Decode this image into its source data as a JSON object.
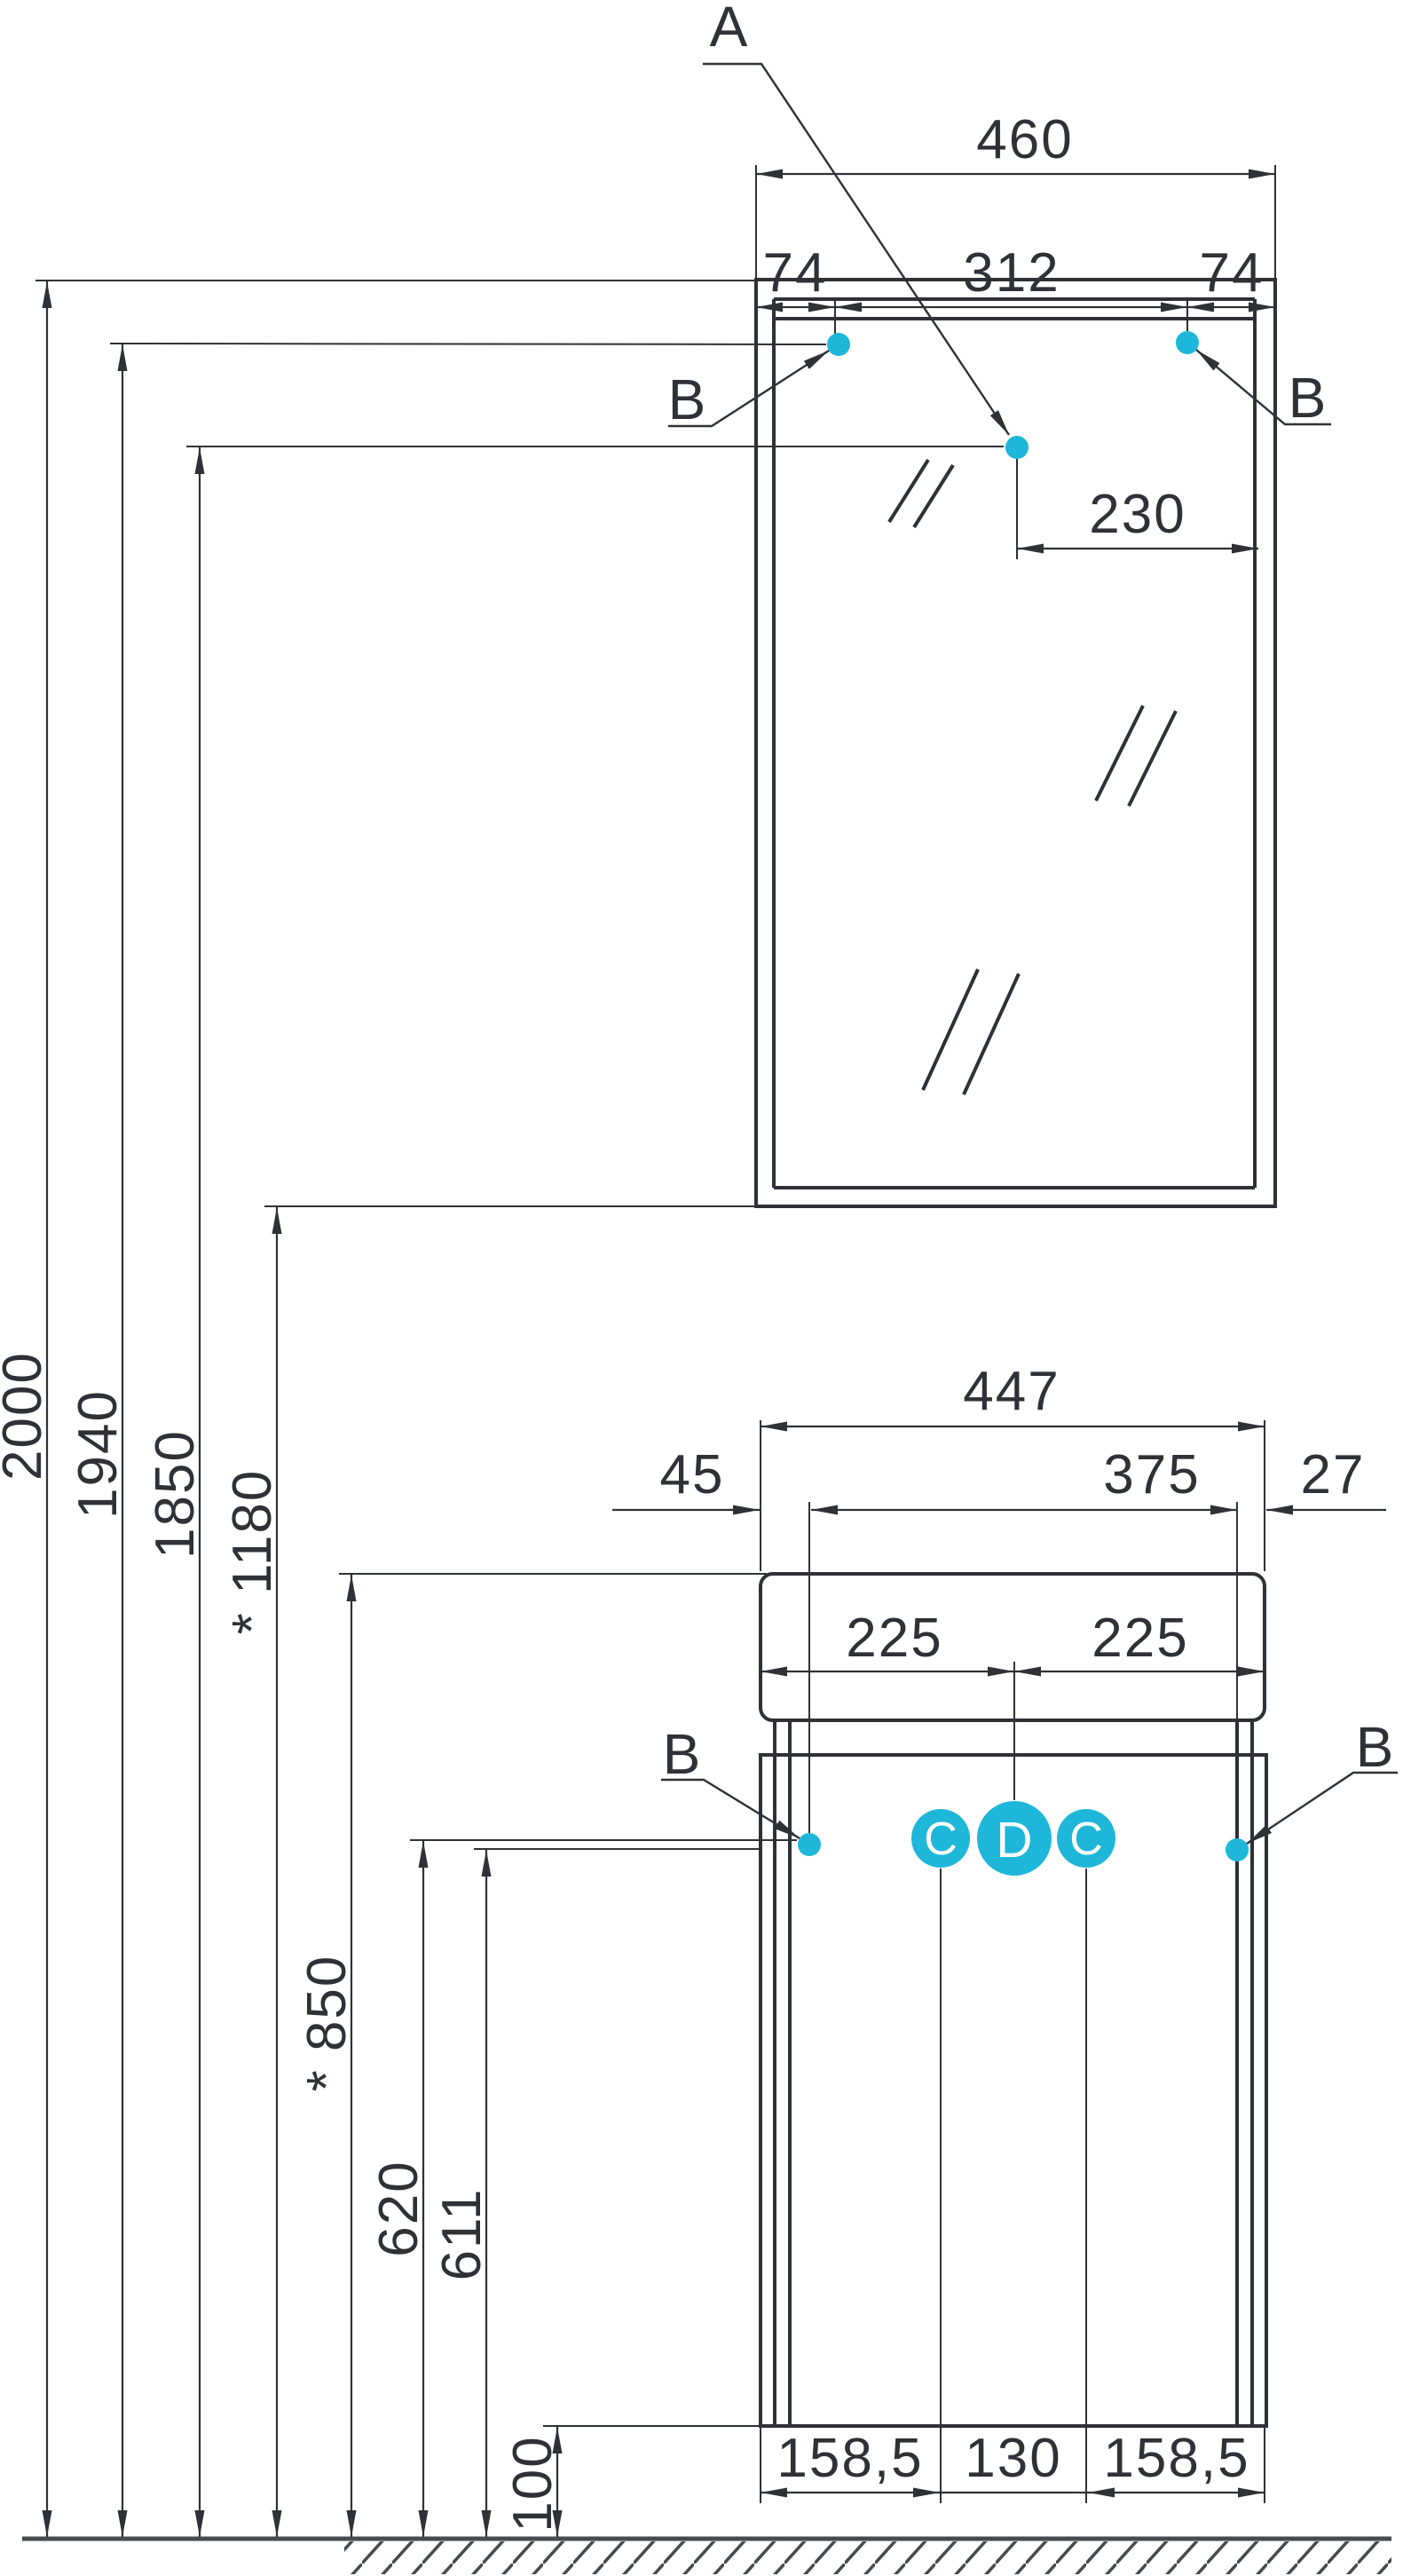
{
  "colors": {
    "accent": "#1eb7da",
    "line": "#2e3136",
    "floor": "#474a4f"
  },
  "callouts": {
    "a": "A",
    "b": "B",
    "c": "C",
    "d": "D"
  },
  "mirror_cabinet": {
    "width": "460",
    "hole_inset_left": "74",
    "hole_span": "312",
    "hole_inset_right": "74",
    "center_hole_offset": "230"
  },
  "heights": {
    "cabinet_top": "2000",
    "mirror_holes": "1940",
    "center_hole": "1850",
    "mirror_bottom": "* 1180",
    "basin_top": "* 850",
    "vanity_hole_top": "620",
    "vanity_hole": "611",
    "plinth": "100"
  },
  "vanity": {
    "basin_width": "447",
    "overhang_left": "45",
    "carcass_width": "375",
    "overhang_right": "27",
    "basin_half_left": "225",
    "basin_half_right": "225",
    "bottom_left": "158,5",
    "bottom_center": "130",
    "bottom_right": "158,5"
  }
}
